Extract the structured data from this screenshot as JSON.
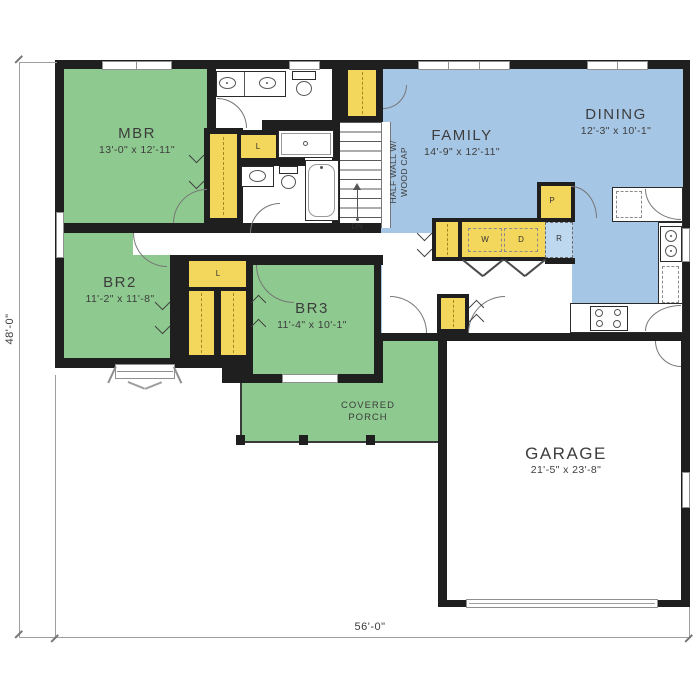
{
  "plan": {
    "rooms": {
      "mbr": {
        "name": "MBR",
        "dims": "13'-0\" x 12'-11\""
      },
      "family": {
        "name": "FAMILY",
        "dims": "14'-9\" x 12'-11\""
      },
      "dining": {
        "name": "DINING",
        "dims": "12'-3\" x 10'-1\""
      },
      "br2": {
        "name": "BR2",
        "dims": "11'-2\" x 11'-8\""
      },
      "br3": {
        "name": "BR3",
        "dims": "11'-4\" x 10'-1\""
      },
      "garage": {
        "name": "GARAGE",
        "dims": "21'-5\" x 23'-8\""
      },
      "porch": {
        "line1": "COVERED",
        "line2": "PORCH"
      }
    },
    "annotations": {
      "half_wall_line1": "HALF WALL W/",
      "half_wall_line2": "WOOD CAP",
      "stairs_down": "DN",
      "linen_bath": "L",
      "linen_hall": "L",
      "washer": "W",
      "dryer": "D",
      "pantry": "P",
      "refrigerator": "R"
    },
    "dimensions": {
      "overall_depth": "48'-0\"",
      "overall_width": "56'-0\""
    },
    "colors": {
      "bedroom_green": "#8ec98f",
      "living_blue": "#a6c6e5",
      "closet_yellow": "#f3d65c",
      "wall_black": "#1f1f1f",
      "refrigerator_blue": "#bdd8ef"
    }
  }
}
